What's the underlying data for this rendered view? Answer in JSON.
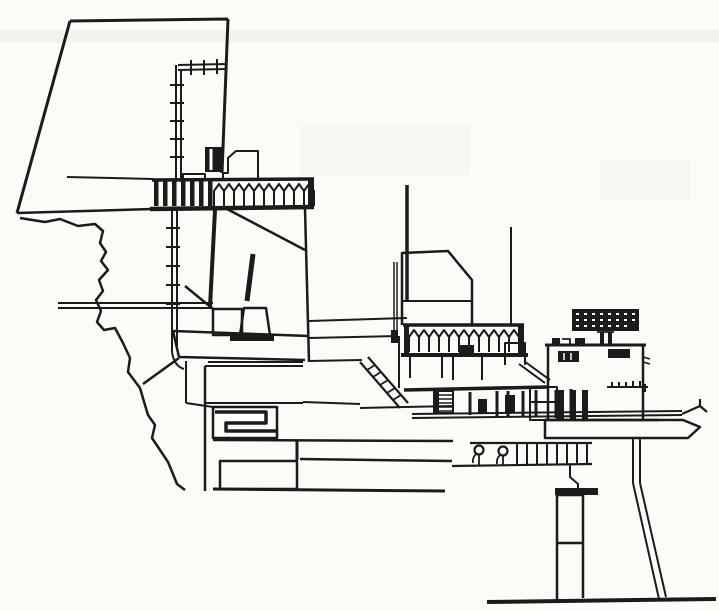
{
  "canvas": {
    "width": 719,
    "height": 611,
    "background": "#fbfbf8",
    "ink": "#1b1b1b"
  },
  "drawing": {
    "elements": [
      {
        "name": "paper-smudge-top",
        "d": "M0,30h719v13h-719z",
        "f": "#f3f3ee"
      },
      {
        "name": "paper-smudge-mid",
        "d": "M300,125h170v50h-170z",
        "f": "#f6f6f2"
      },
      {
        "name": "paper-smudge-right",
        "d": "M600,160h90v40h-90z",
        "f": "#f6f6f2"
      },
      {
        "name": "cliff-outline",
        "d": "M70,21L228,19M228,19L222,173M70,21L17,213",
        "w": 3
      },
      {
        "name": "upper-deck-line",
        "d": "M67,177L153,179",
        "w": 2
      },
      {
        "name": "deck-base-line-left",
        "d": "M17,213L152,209",
        "w": 2.5
      },
      {
        "name": "deck-base-line-right",
        "d": "M150,209L314,207",
        "w": 4.5
      },
      {
        "name": "left-railing-top-rail",
        "d": "M152,180L314,179",
        "w": 3.5
      },
      {
        "name": "left-railing-bars",
        "d": "M154,181h4.5v25h-4.5zM163,181h4.5v25h-4.5zM172,181h4.5v25h-4.5zM181,181h4.5v25h-4.5zM190,181h4.5v25h-4.5zM199,181h4.5v25h-4.5zM208,181h4.5v25h-4.5z",
        "f": "ink"
      },
      {
        "name": "left-railing-pickets",
        "d": "M214,206V191L219,184L224,191V206M224,206V191L229,184L234,191V206M234,206V191L239,184L244,191V206M244,206V191L249,184L254,191V206M254,206V191L259,184L264,191V206M264,206V191L269,184L274,191V206M274,206V191L279,184L284,191V206M284,206V191L289,184L294,191V206M294,206V191L299,184L304,191V206M304,206V191L309,184L314,191V206",
        "w": 2
      },
      {
        "name": "left-railing-end-post",
        "d": "M308,180h6v27h-6z",
        "f": "ink"
      },
      {
        "name": "pipe-mast-top-run",
        "d": "M178,65L227,64M178,70L227,69M176,65L176,182M181,70L181,182",
        "w": 2
      },
      {
        "name": "pipe-mast-top-flanges",
        "d": "M191,60V75M204,60V75M217,59V74M170,85h14M170,103h14M170,121h14M170,139h14M170,157h14",
        "w": 2
      },
      {
        "name": "pipe-mast-lower-run",
        "d": "M172,209V352M177,209V350M172,352Q174,366 184,369",
        "w": 2
      },
      {
        "name": "pipe-mast-lower-flanges",
        "d": "M166,228h14M166,247h14M166,266h14M166,285h14M166,304h14",
        "w": 2
      },
      {
        "name": "rooftop-box",
        "d": "M183,181v-7h22v7",
        "w": 2
      },
      {
        "name": "rooftop-cabinet",
        "d": "M205,147h17v25h-17z",
        "f": "ink"
      },
      {
        "name": "rooftop-cabinet-slit",
        "d": "M211,149v21",
        "s": "#ffffff",
        "w": 3
      },
      {
        "name": "rooftop-hut",
        "d": "M223,180V173H228V158L236,151H258V180",
        "w": 2
      },
      {
        "name": "gun-room-right-wall",
        "d": "M305,209L309,362",
        "w": 2.5
      },
      {
        "name": "gun-room-braces",
        "d": "M227,209L305,250M185,286L213,309",
        "w": 2.5
      },
      {
        "name": "gun-room-column",
        "d": "M215,210L210,307",
        "w": 4
      },
      {
        "name": "gun-room-floor-slab",
        "d": "M173,331L309,336M179,357L305,360M173,331L179,357",
        "w": 2.5
      },
      {
        "name": "cliff-strut",
        "d": "M143,384L179,358",
        "w": 2.5
      },
      {
        "name": "gun-barrel",
        "d": "M253,254L247,301",
        "w": 5
      },
      {
        "name": "gun-pedestal",
        "d": "M244,308L266,308L270,335L240,335Z",
        "w": 2.5
      },
      {
        "name": "gun-mount-box",
        "d": "M213,309h29v26h-29z",
        "w": 2.5
      },
      {
        "name": "gun-mount-sill",
        "d": "M230,335h44v6h-44z",
        "f": "ink"
      },
      {
        "name": "access-pipe",
        "d": "M58,303H213M58,308H213",
        "w": 2
      },
      {
        "name": "terrain-rock-face",
        "d": "M20,218L45,222L60,219L78,226L95,224L103,231L100,243L106,252L101,261L108,270L99,280L103,291L96,300L101,311L97,322L104,330L115,328L123,343L130,358L128,372L140,388L145,405L148,415L155,425L152,438L160,450L168,462L173,474L177,484L185,490",
        "w": 2.5
      },
      {
        "name": "hull-left-edge",
        "d": "M205,366V491",
        "w": 2.5
      },
      {
        "name": "hull-top-lines",
        "d": "M205,366H303M208,362H303M186,361V403M186,403L213,407",
        "w": 2
      },
      {
        "name": "hull-row-line",
        "d": "M205,403H303",
        "w": 2
      },
      {
        "name": "meander-frame",
        "d": "M213,407h64v31h-64z",
        "w": 2.5
      },
      {
        "name": "meander-duct",
        "d": "M215,412H266V423H226V431H276",
        "w": 3.5
      },
      {
        "name": "hull-line-440",
        "d": "M213,440L453,441",
        "w": 2.5
      },
      {
        "name": "hull-divider",
        "d": "M297,441V460",
        "w": 3
      },
      {
        "name": "hull-line-460",
        "d": "M300,459L452,461",
        "w": 2.5
      },
      {
        "name": "hull-lower-box",
        "d": "M220,461h77v28h-77z",
        "w": 2.5
      },
      {
        "name": "hull-bottom-line",
        "d": "M213,489L445,491",
        "w": 3
      },
      {
        "name": "hull-mid-lines",
        "d": "M303,402L360,404M360,408L453,406",
        "w": 2
      },
      {
        "name": "mid-deck-lines",
        "d": "M309,321L407,318M309,338L398,336M309,361L362,360M399,336V388",
        "w": 2
      },
      {
        "name": "stairs-stringers",
        "d": "M360,362L400,408M368,357L408,403",
        "w": 2.2
      },
      {
        "name": "stairs-steps",
        "d": "M367,370L375,365M373,377L381,372M380,385L388,380M387,393L395,388M393,400L401,395",
        "w": 1.8
      },
      {
        "name": "mid-deck-boxes",
        "d": "M410,378v-24h32v24M453,380v-25h29v25",
        "w": 2
      },
      {
        "name": "mid-grate-frame",
        "d": "M434,391h19v22h-19z",
        "w": 2
      },
      {
        "name": "mid-grate-rungs",
        "d": "M434,395h19M434,399h19M434,403h19M434,407h19M434,411h19",
        "w": 1.5
      },
      {
        "name": "mid-grate-dark-edge",
        "d": "M434,391h5v22h-5z",
        "f": "ink"
      },
      {
        "name": "center-cabin",
        "d": "M402,325V253L448,251L472,280V325",
        "w": 2.5
      },
      {
        "name": "center-cabin-deckline",
        "d": "M402,301H472",
        "w": 2
      },
      {
        "name": "main-mast",
        "d": "M407,185V301",
        "w": 3.5
      },
      {
        "name": "aft-mast",
        "d": "M511,227V325",
        "w": 2
      },
      {
        "name": "cabin-front-post",
        "d": "M394,262V330M397,262V330",
        "w": 1.5
      },
      {
        "name": "cabin-post-footing",
        "d": "M391,330h7v13h-7z",
        "f": "ink"
      },
      {
        "name": "center-railing-top-rail",
        "d": "M403,325H524",
        "w": 3.5
      },
      {
        "name": "center-railing-pickets",
        "d": "M409,352V337L414,330L419,337V352M419,352V337L424,330L429,337V352M429,352V337L434,330L439,337V352M439,352V337L444,330L449,337V352M449,352V337L454,330L459,337V352M459,352V337L464,330L469,337V352M469,352V337L474,330L479,337V352M479,352V337L484,330L489,337V352M489,352V337L494,330L499,337V352M499,352V337L504,330L509,337V352M509,352V337L514,330L519,337V352",
        "w": 2
      },
      {
        "name": "center-railing-bottom-rail",
        "d": "M401,355H528",
        "w": 4
      },
      {
        "name": "center-railing-end-posts",
        "d": "M404,326h5v28h-5zM518,326h6v28h-6z",
        "f": "ink"
      },
      {
        "name": "center-railing-fitting",
        "d": "M459,345h15v10h-15z",
        "f": "ink"
      },
      {
        "name": "aft-band-box",
        "d": "M505,365v-22h20v22",
        "w": 2
      },
      {
        "name": "walkway-diagonals",
        "d": "M519,364L545,383M524,361L550,380",
        "w": 2
      },
      {
        "name": "main-deck-line-right",
        "d": "M404,390L548,387",
        "w": 3.5
      },
      {
        "name": "colonnade-posts",
        "d": "M470,392V415M497,391V416M508,391V416M523,391V416M536,390V417M556,390V418M571,389V418",
        "w": 3
      },
      {
        "name": "colonnade-dark-posts",
        "d": "M478,399h9v14h-9zM505,395h10v17h-10z",
        "f": "ink"
      },
      {
        "name": "boom-chords",
        "d": "M412,414L682,411M412,418L682,415",
        "w": 2
      },
      {
        "name": "boom-tip-hook",
        "d": "M682,414L700,406M700,406L700,399M700,406L707,412",
        "w": 2.2
      },
      {
        "name": "boom-beam",
        "d": "M545,420H683L700,427L688,438H545Z",
        "w": 2.5
      },
      {
        "name": "bollard-deck-rails",
        "d": "M470,443H592M452,466L592,464",
        "w": 2.2
      },
      {
        "name": "bollard-deck-stanchions",
        "d": "M517,443V464M527,443V464M537,443V464M547,443V464M557,443V464M567,443V464M577,443V464M587,443V464",
        "w": 2
      },
      {
        "name": "bollard-fore",
        "type": "circle",
        "cx": 479,
        "cy": 450,
        "r": 4.5,
        "w": 2.2
      },
      {
        "name": "bollard-aft",
        "type": "circle",
        "cx": 503,
        "cy": 451,
        "r": 4.5,
        "w": 2.2
      },
      {
        "name": "bollard-stems",
        "d": "M479,455V465M476,454Q472,458 473,463M503,456V465M500,455Q496,459 497,464",
        "w": 1.8
      },
      {
        "name": "support-step-notch",
        "d": "M570,464V477L578,484V489",
        "w": 2
      },
      {
        "name": "support-cap-bar",
        "d": "M555,488h43v7h-43z",
        "f": "ink"
      },
      {
        "name": "support-column",
        "d": "M557,495V601M583,495V598M557,495H583M557,543H583",
        "w": 2.5
      },
      {
        "name": "support-brace",
        "d": "M633,438V483M640,438V483M633,483L659,599M640,483L666,597",
        "w": 2
      },
      {
        "name": "ground-line",
        "d": "M487,602L716,599",
        "w": 4
      },
      {
        "name": "deckhouse",
        "d": "M548,420V345H643V420",
        "w": 2.5
      },
      {
        "name": "deckhouse-roof-edge",
        "d": "M545,345H646",
        "w": 3
      },
      {
        "name": "deckhouse-windows",
        "d": "M558,351h21v11h-21zM608,349h22v9h-22z",
        "f": "ink"
      },
      {
        "name": "deckhouse-window-slits",
        "d": "M564,353v7M571,353v7",
        "s": "#ffffff",
        "w": 1.5
      },
      {
        "name": "roof-fittings",
        "d": "M552,338h8v7h-8zM575,338h10v7h-10zM600,332h4v13h-4zM608,332h4v13h-4z",
        "f": "ink"
      },
      {
        "name": "roof-fitting-outline",
        "d": "M562,339h8v6h-8M597,332h17",
        "w": 1.8
      },
      {
        "name": "radar-antenna",
        "d": "M572,309h67v22h-67z",
        "f": "ink"
      },
      {
        "name": "radar-speckles",
        "d": "M576,313h3v2h-3zM584,313h3v2h-3zM592,313h3v2h-3zM600,313h3v2h-3zM608,313h3v2h-3zM616,313h3v2h-3zM624,313h3v2h-3zM632,313h3v2h-3zM576,319h3v2h-3zM584,319h3v2h-3zM592,319h3v2h-3zM600,319h3v2h-3zM608,319h3v2h-3zM616,319h3v2h-3zM624,319h3v2h-3zM632,319h3v2h-3zM576,325h3v2h-3zM584,325h3v2h-3zM592,325h3v2h-3zM600,325h3v2h-3zM608,325h3v2h-3zM616,325h3v2h-3zM624,325h3v2h-3z",
        "f": "#ffffff"
      },
      {
        "name": "deckhouse-railing",
        "d": "M607,387H648M612,382v5M619,382v5M626,382v5M633,381v5M640,381v5M645,384v8",
        "w": 2
      },
      {
        "name": "deckhouse-side-nubs",
        "d": "M643,357l7,2M643,362l7,2",
        "w": 1.5
      },
      {
        "name": "under-deckhouse-boxes",
        "d": "M530,387h27v33h-27zM530,402h27",
        "w": 2
      },
      {
        "name": "under-deckhouse-columns",
        "d": "M558,390h6v30h-6zM570,390h6v30h-6zM582,390h6v30h-6z",
        "f": "ink"
      },
      {
        "name": "deckhouse-base-line",
        "d": "M545,420H658",
        "w": 2.5
      }
    ]
  }
}
